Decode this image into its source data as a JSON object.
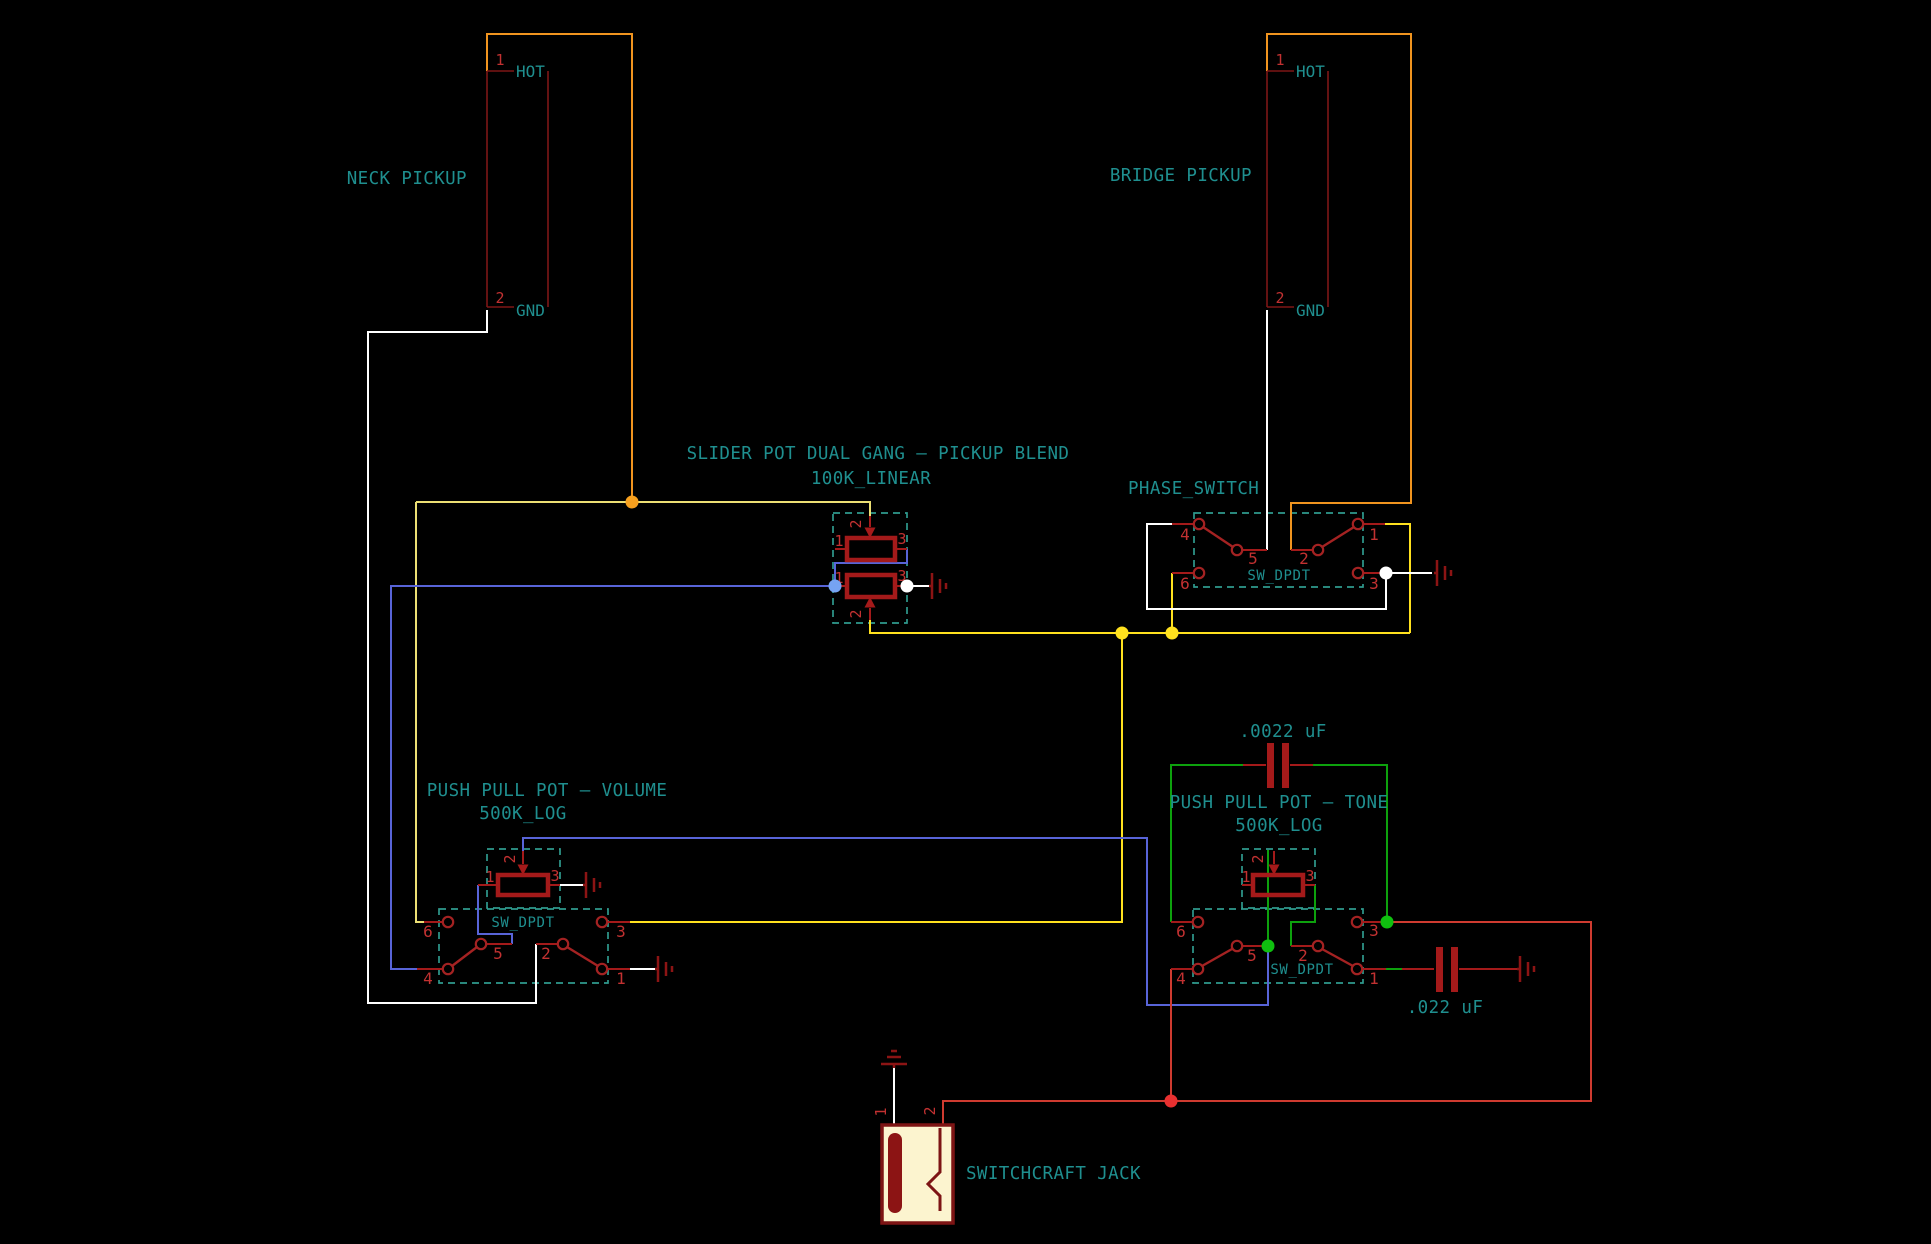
{
  "neck_pickup": {
    "label": "NECK PICKUP",
    "pins": {
      "p1": "1",
      "p2": "2"
    },
    "pin_names": {
      "hot": "HOT",
      "gnd": "GND"
    }
  },
  "bridge_pickup": {
    "label": "BRIDGE PICKUP",
    "pins": {
      "p1": "1",
      "p2": "2"
    },
    "pin_names": {
      "hot": "HOT",
      "gnd": "GND"
    }
  },
  "blend_pot": {
    "title": "SLIDER POT DUAL GANG – PICKUP BLEND",
    "value": "100K_LINEAR",
    "gang1": {
      "p1": "1",
      "p2": "2",
      "p3": "3"
    },
    "gang2": {
      "p1": "1",
      "p2": "2",
      "p3": "3"
    }
  },
  "phase_switch": {
    "label": "PHASE_SWITCH",
    "part": "SW_DPDT",
    "pins": {
      "p1": "1",
      "p2": "2",
      "p3": "3",
      "p4": "4",
      "p5": "5",
      "p6": "6"
    }
  },
  "volume_pot": {
    "title": "PUSH PULL POT – VOLUME",
    "value": "500K_LOG",
    "part": "SW_DPDT",
    "pot_pins": {
      "p1": "1",
      "p2": "2",
      "p3": "3"
    },
    "switch_pins": {
      "p1": "1",
      "p2": "2",
      "p3": "3",
      "p4": "4",
      "p5": "5",
      "p6": "6"
    }
  },
  "tone_pot": {
    "title": "PUSH PULL POT – TONE",
    "value": "500K_LOG",
    "part": "SW_DPDT",
    "pot_pins": {
      "p1": "1",
      "p2": "2",
      "p3": "3"
    },
    "switch_pins": {
      "p1": "1",
      "p2": "2",
      "p3": "3",
      "p4": "4",
      "p5": "5",
      "p6": "6"
    }
  },
  "caps": {
    "blend_cap": {
      "value": ".0022 uF"
    },
    "tone_cap": {
      "value": ".022 uF"
    }
  },
  "jack": {
    "label": "SWITCHCRAFT JACK",
    "pins": {
      "p1": "1",
      "p2": "2"
    }
  },
  "colors": {
    "background": "#000000",
    "wire_red": "#cf3b30",
    "wire_orange": "#f0941f",
    "wire_yellow": "#ffe11e",
    "wire_pale_yellow": "#ecdf74",
    "wire_blue": "#5864d8",
    "wire_white": "#ffffff",
    "wire_green": "#0da10d",
    "symbol_red": "#a41a1a",
    "text_teal": "#1f8f8f",
    "pin_number_red": "#c23131"
  }
}
